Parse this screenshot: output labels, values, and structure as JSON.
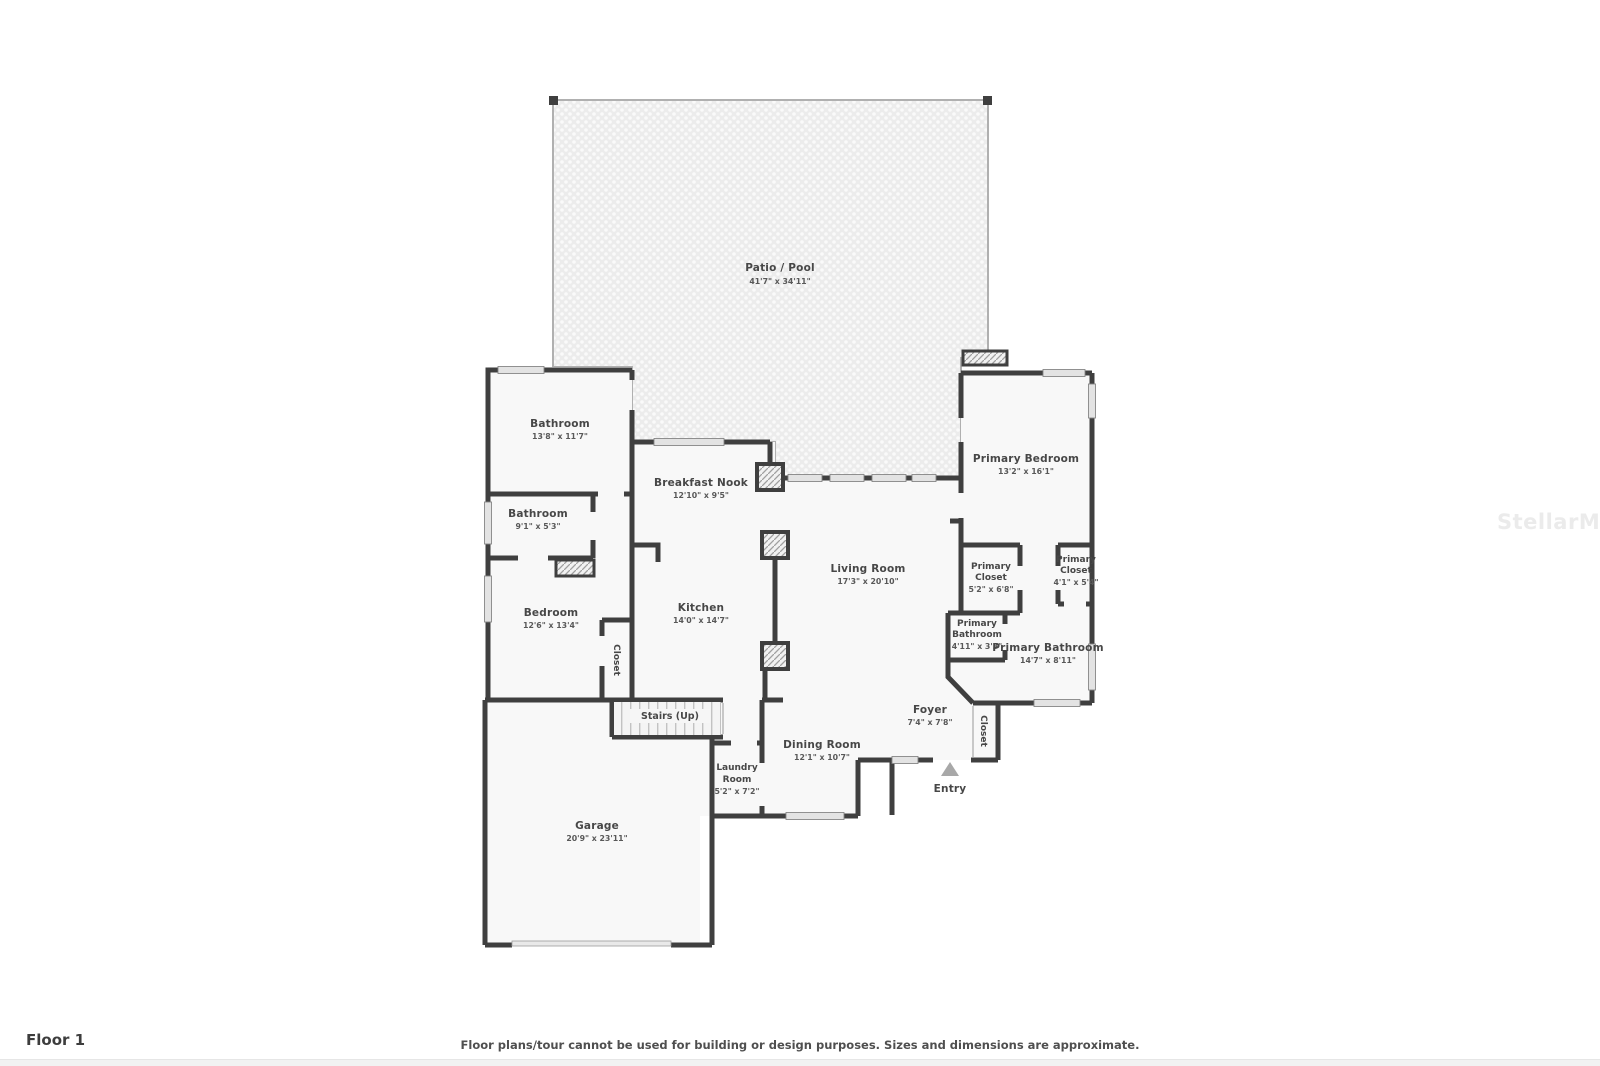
{
  "page": {
    "floor_label": "Floor 1",
    "disclaimer": "Floor plans/tour cannot be used for building or design purposes. Sizes and dimensions are approximate.",
    "watermark": "StellarMLS"
  },
  "colors": {
    "wall": "#3f3f3f",
    "room_fill": "#f8f8f8",
    "patio_fill": "#ececec",
    "window_fill": "#e3e3e3",
    "hatch_stroke": "#9f9f9f",
    "text": "#474747",
    "entry_arrow": "#a8a8a8",
    "watermark": "#ebebeb"
  },
  "rooms": {
    "patio": {
      "lines": [
        "Patio / Pool"
      ],
      "dims": "41'7\" x 34'11\""
    },
    "bathroom_large": {
      "lines": [
        "Bathroom"
      ],
      "dims": "13'8\" x 11'7\""
    },
    "bathroom_small": {
      "lines": [
        "Bathroom"
      ],
      "dims": "9'1\" x 5'3\""
    },
    "breakfast_nook": {
      "lines": [
        "Breakfast Nook"
      ],
      "dims": "12'10\" x 9'5\""
    },
    "primary_bedroom": {
      "lines": [
        "Primary Bedroom"
      ],
      "dims": "13'2\" x 16'1\""
    },
    "primary_closet_left": {
      "lines": [
        "Primary",
        "Closet"
      ],
      "dims": "5'2\" x 6'8\""
    },
    "primary_closet_right": {
      "lines": [
        "Primary",
        "Closet"
      ],
      "dims": "4'1\" x 5'4\""
    },
    "primary_bathroom_small": {
      "lines": [
        "Primary",
        "Bathroom"
      ],
      "dims": "4'11\" x 3'3\""
    },
    "primary_bathroom_large": {
      "lines": [
        "Primary Bathroom"
      ],
      "dims": "14'7\" x 8'11\""
    },
    "living_room": {
      "lines": [
        "Living Room"
      ],
      "dims": "17'3\" x 20'10\""
    },
    "kitchen": {
      "lines": [
        "Kitchen"
      ],
      "dims": "14'0\" x 14'7\""
    },
    "bedroom": {
      "lines": [
        "Bedroom"
      ],
      "dims": "12'6\" x 13'4\""
    },
    "bedroom_closet": {
      "lines": [
        "Closet"
      ],
      "dims": ""
    },
    "stairs": {
      "lines": [
        "Stairs (Up)"
      ],
      "dims": ""
    },
    "laundry_room": {
      "lines": [
        "Laundry",
        "Room"
      ],
      "dims": "5'2\" x 7'2\""
    },
    "dining_room": {
      "lines": [
        "Dining Room"
      ],
      "dims": "12'1\" x 10'7\""
    },
    "foyer": {
      "lines": [
        "Foyer"
      ],
      "dims": "7'4\" x 7'8\""
    },
    "foyer_closet": {
      "lines": [
        "Closet"
      ],
      "dims": ""
    },
    "entry": {
      "lines": [
        "Entry"
      ],
      "dims": ""
    },
    "garage": {
      "lines": [
        "Garage"
      ],
      "dims": "20'9\" x 23'11\""
    }
  }
}
